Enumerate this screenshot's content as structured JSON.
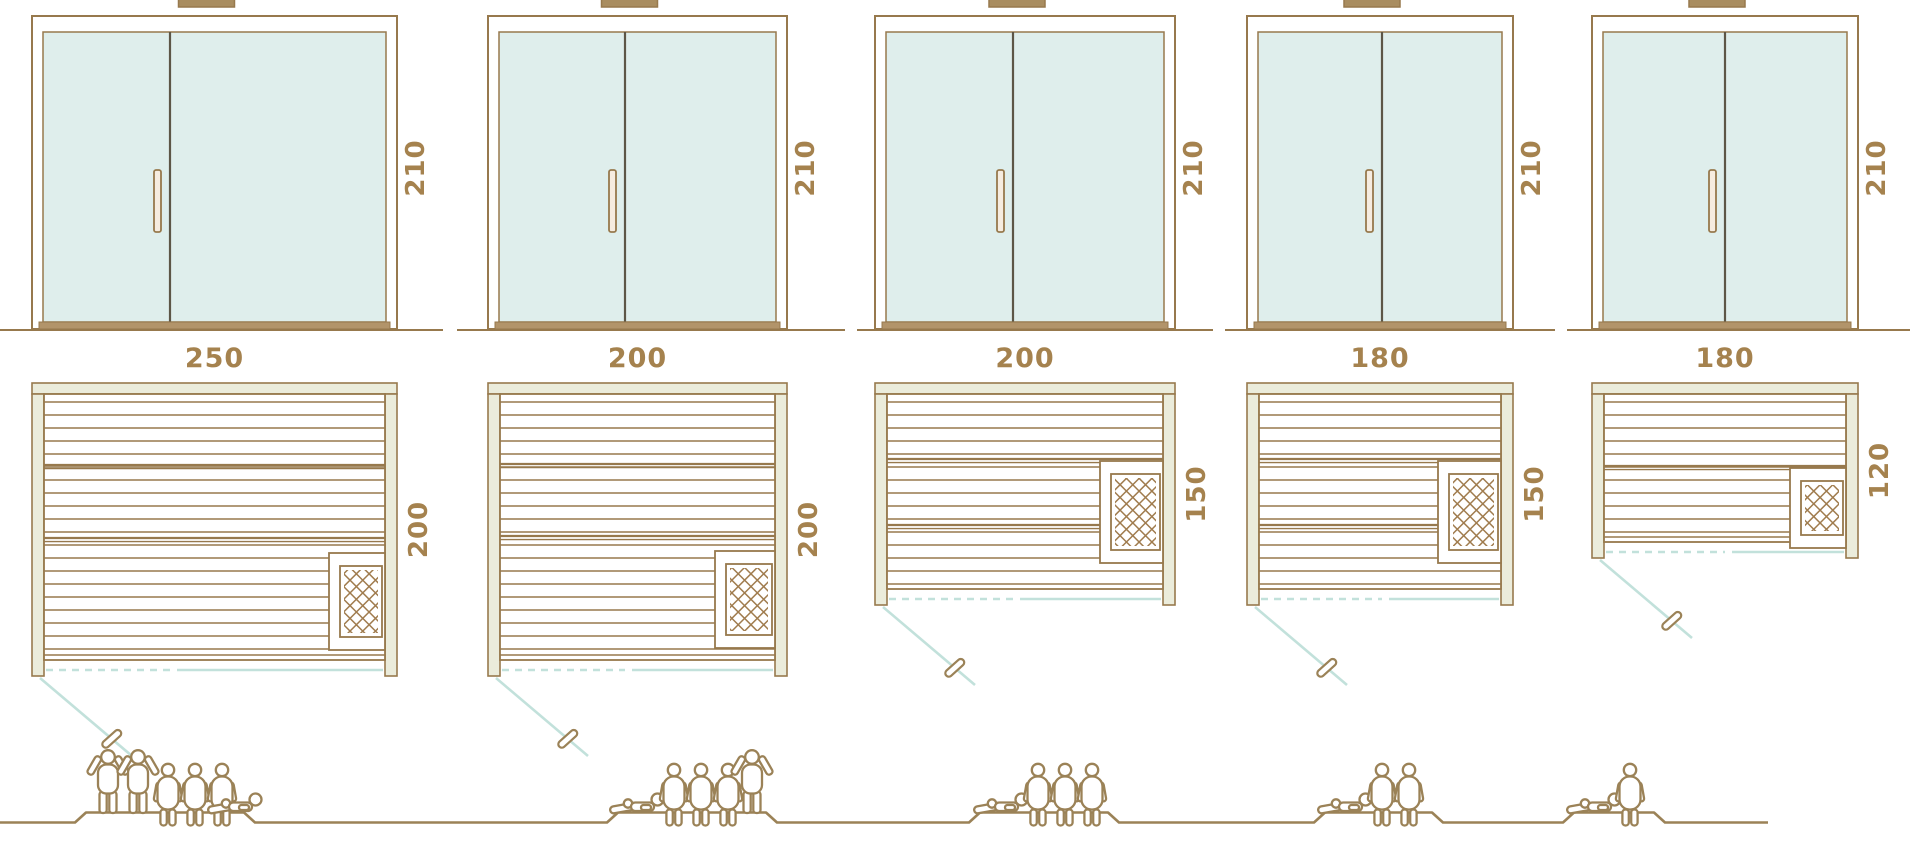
{
  "diagram": {
    "kind": "sauna-size-comparison",
    "colors": {
      "line_brown": "#97794d",
      "divider_dark": "#5d5647",
      "glass_fill": "#dfeeec",
      "wall_fill": "#ebecdb",
      "threshold_fill": "#b2946a",
      "swing_teal": "#c2e1db",
      "dimension_text": "#a5824e",
      "figure_brown": "#9b8257",
      "heater_brown": "#a07c4e"
    },
    "units": [
      {
        "id": "sauna-250x200",
        "width_label": "250",
        "depth_label": "200",
        "height_label": "210",
        "width_cm": 250,
        "depth_cm": 200,
        "height_cm": 210,
        "capacity": {
          "total": 6,
          "standing": 2,
          "seated": 3,
          "lying": 1,
          "figures": [
            "standing",
            "standing",
            "seated",
            "seated",
            "seated",
            "lying"
          ]
        }
      },
      {
        "id": "sauna-200x200",
        "width_label": "200",
        "depth_label": "200",
        "height_label": "210",
        "width_cm": 200,
        "depth_cm": 200,
        "height_cm": 210,
        "capacity": {
          "total": 5,
          "standing": 1,
          "seated": 3,
          "lying": 1,
          "figures": [
            "lying",
            "seated",
            "seated",
            "seated",
            "standing"
          ]
        }
      },
      {
        "id": "sauna-200x150",
        "width_label": "200",
        "depth_label": "150",
        "height_label": "210",
        "width_cm": 200,
        "depth_cm": 150,
        "height_cm": 210,
        "capacity": {
          "total": 4,
          "standing": 0,
          "seated": 3,
          "lying": 1,
          "figures": [
            "lying",
            "seated",
            "seated",
            "seated"
          ]
        }
      },
      {
        "id": "sauna-180x150",
        "width_label": "180",
        "depth_label": "150",
        "height_label": "210",
        "width_cm": 180,
        "depth_cm": 150,
        "height_cm": 210,
        "capacity": {
          "total": 3,
          "standing": 0,
          "seated": 2,
          "lying": 1,
          "figures": [
            "lying",
            "seated",
            "seated"
          ]
        }
      },
      {
        "id": "sauna-180x120",
        "width_label": "180",
        "depth_label": "120",
        "height_label": "210",
        "width_cm": 180,
        "depth_cm": 120,
        "height_cm": 210,
        "capacity": {
          "total": 2,
          "standing": 0,
          "seated": 1,
          "lying": 1,
          "figures": [
            "lying",
            "seated"
          ]
        }
      }
    ]
  }
}
